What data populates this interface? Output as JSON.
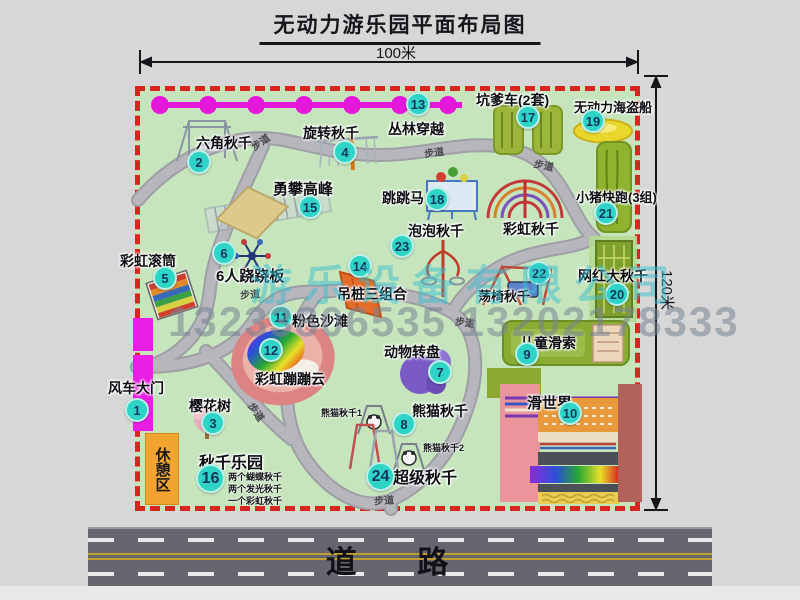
{
  "title": "无动力游乐园平面布局图",
  "dimensions": {
    "width_label": "100米",
    "height_label": "120米"
  },
  "road": {
    "label": "道 路"
  },
  "watermark": {
    "company": "游乐设备有限公司",
    "phone": "13233806535 13202178333"
  },
  "map": {
    "path_label": "步道",
    "extras": {
      "rainbow_swing": "彩虹秋千",
      "rest_area": "休憩区",
      "panda1": "熊猫秋千1",
      "panda2": "熊猫秋千2"
    },
    "items": [
      {
        "num": "1",
        "label": "风车大门"
      },
      {
        "num": "2",
        "label": "六角秋千"
      },
      {
        "num": "3",
        "label": "樱花树"
      },
      {
        "num": "4",
        "label": "旋转秋千"
      },
      {
        "num": "5",
        "label": "彩虹滚筒"
      },
      {
        "num": "6",
        "label": "6人跷跷板"
      },
      {
        "num": "7",
        "label": "动物转盘"
      },
      {
        "num": "8",
        "label": "熊猫秋千"
      },
      {
        "num": "9",
        "label": "儿童滑索"
      },
      {
        "num": "10",
        "label": "滑世界"
      },
      {
        "num": "11",
        "label": "粉色沙滩"
      },
      {
        "num": "12",
        "label": "彩虹蹦蹦云"
      },
      {
        "num": "13",
        "label": "丛林穿越"
      },
      {
        "num": "14",
        "label": "吊桩三组合"
      },
      {
        "num": "15",
        "label": "勇攀高峰"
      },
      {
        "num": "16",
        "label": "秋千乐园",
        "notes": [
          "两个蝴蝶秋千",
          "两个发光秋千",
          "一个彩虹秋千"
        ]
      },
      {
        "num": "17",
        "label": "坑爹车(2套)"
      },
      {
        "num": "18",
        "label": "跳跳马"
      },
      {
        "num": "19",
        "label": "无动力海盗船"
      },
      {
        "num": "20",
        "label": "网红大秋千"
      },
      {
        "num": "21",
        "label": "小猪快跑(3组)"
      },
      {
        "num": "22",
        "label": "荡椅秋千"
      },
      {
        "num": "23",
        "label": "泡泡秋千"
      },
      {
        "num": "24",
        "label": "超级秋千"
      }
    ]
  }
}
